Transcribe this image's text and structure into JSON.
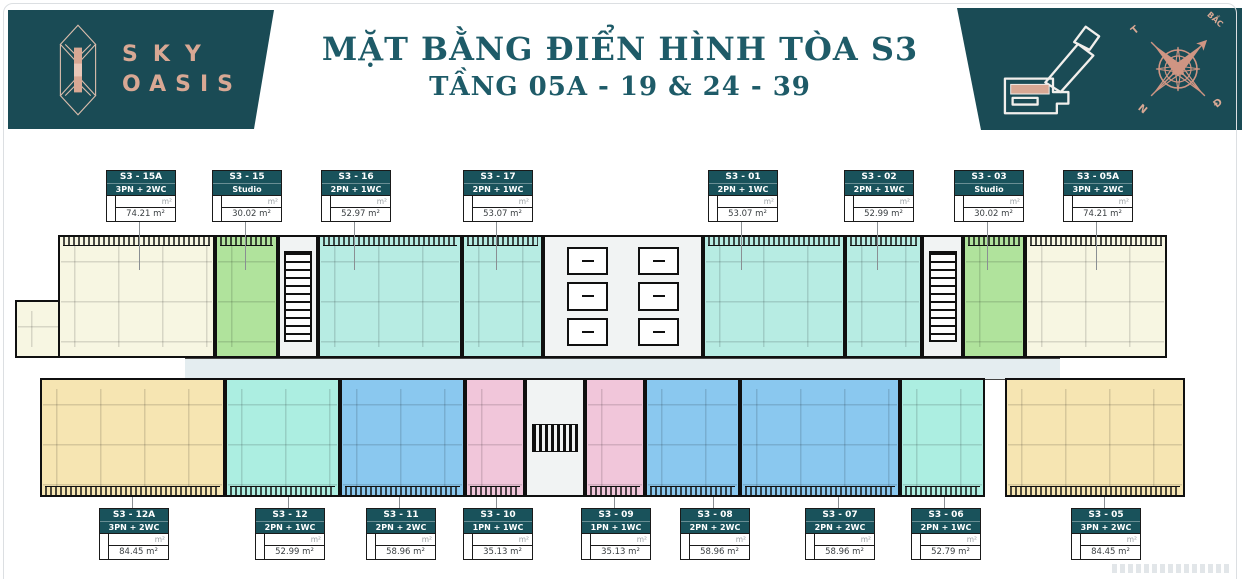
{
  "header": {
    "brand_line1": "SKY",
    "brand_line2": "OASIS",
    "title": "MẶT BẰNG ĐIỂN HÌNH TÒA S3",
    "subtitle": "TẦNG 05A - 19 & 24 - 39",
    "compass": {
      "north": "BẮC",
      "east": "Đ",
      "south": "N",
      "west": "T"
    }
  },
  "labels": {
    "area_unit": "m²"
  },
  "units_top": [
    {
      "code": "S3 - 15A",
      "type": "3PN + 2WC",
      "area": "74.21 m²"
    },
    {
      "code": "S3 - 15",
      "type": "Studio",
      "area": "30.02 m²"
    },
    {
      "code": "S3 - 16",
      "type": "2PN + 1WC",
      "area": "52.97 m²"
    },
    {
      "code": "S3 - 17",
      "type": "2PN + 1WC",
      "area": "53.07 m²"
    },
    {
      "code": "S3 - 01",
      "type": "2PN + 1WC",
      "area": "53.07 m²"
    },
    {
      "code": "S3 - 02",
      "type": "2PN + 1WC",
      "area": "52.99 m²"
    },
    {
      "code": "S3 - 03",
      "type": "Studio",
      "area": "30.02 m²"
    },
    {
      "code": "S3 - 05A",
      "type": "3PN + 2WC",
      "area": "74.21 m²"
    }
  ],
  "units_bottom": [
    {
      "code": "S3 - 12A",
      "type": "3PN + 2WC",
      "area": "84.45 m²"
    },
    {
      "code": "S3 - 12",
      "type": "2PN + 1WC",
      "area": "52.99 m²"
    },
    {
      "code": "S3 - 11",
      "type": "2PN + 2WC",
      "area": "58.96 m²"
    },
    {
      "code": "S3 - 10",
      "type": "1PN + 1WC",
      "area": "35.13 m²"
    },
    {
      "code": "S3 - 09",
      "type": "1PN + 1WC",
      "area": "35.13 m²"
    },
    {
      "code": "S3 - 08",
      "type": "2PN + 2WC",
      "area": "58.96 m²"
    },
    {
      "code": "S3 - 07",
      "type": "2PN + 2WC",
      "area": "58.96 m²"
    },
    {
      "code": "S3 - 06",
      "type": "2PN + 1WC",
      "area": "52.79 m²"
    },
    {
      "code": "S3 - 05",
      "type": "3PN + 2WC",
      "area": "84.45 m²"
    }
  ],
  "colors": {
    "banner_teal": "#1a4b55",
    "title_teal": "#1e5b68",
    "copper": "#d8a894",
    "card_header_teal": "#19525b",
    "unit_cream": "#f7f6e2",
    "unit_green": "#b0e39c",
    "unit_cyan_top": "#b7ece3",
    "unit_cyan_bottom": "#aceee1",
    "unit_blue": "#8ac8ef",
    "unit_pink": "#f1c6da",
    "unit_tan": "#f6e5b2",
    "core_white": "#f1f3f3",
    "wall_black": "#101010"
  }
}
